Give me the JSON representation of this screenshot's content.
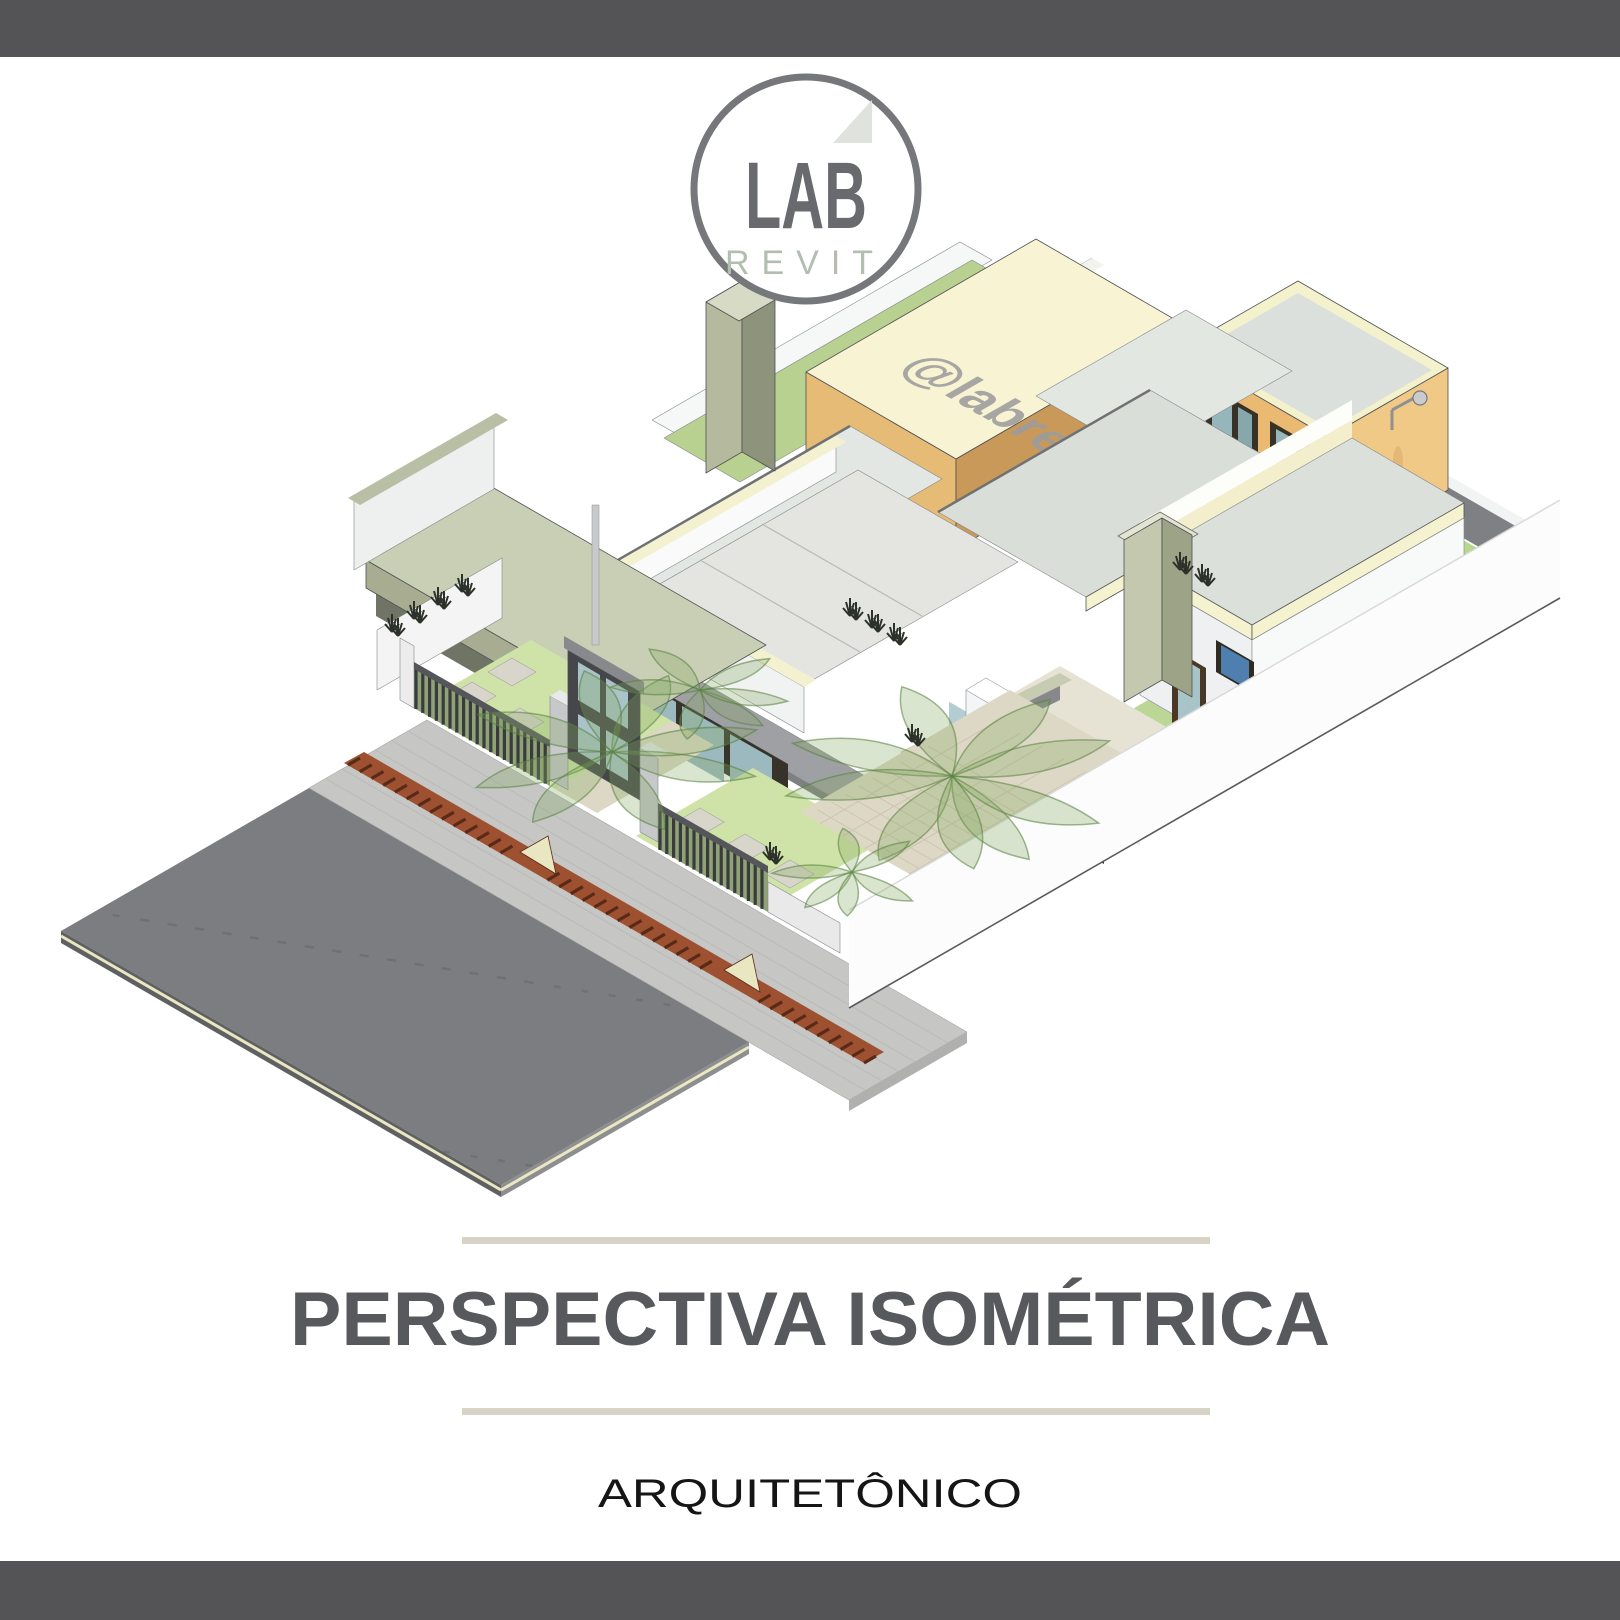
{
  "page": {
    "type": "social-media architectural graphic",
    "background_color": "#ffffff",
    "top_bar_color": "#545456",
    "bottom_bar_color": "#545456"
  },
  "logo": {
    "line1": "LAB",
    "line2": "REVIT",
    "ring_color": "#76777a",
    "lab_color": "#696a6d",
    "revit_color": "#b1beb0",
    "triangle_color": "#dfe2dd"
  },
  "watermark": {
    "text": "@labrevit",
    "color": "#9c9c9c"
  },
  "title_block": {
    "title": "PERSPECTIVA ISOMÉTRICA",
    "title_color": "#58595c",
    "rule_color": "#d8d2c7",
    "subtitle": "ARQUITETÔNICO",
    "subtitle_color": "#151515"
  },
  "scene": {
    "description": "Isometric cutaway Revit model of a duplex house: asphalt street, paver sidewalk with terracotta drainage channel, dark slatted front fence with gate and gabion pillars, front lawns with concrete pavers and translucent plants, sage carport canopy, white cut walls with cream caps, tan clerestory roof volume, light gable and flat roofs, two-storey orange tower with outdoor shower, enclosed back lawn",
    "palette": {
      "asphalt": "#7c7d80",
      "sidewalk": "#c6c6c4",
      "channel_terracotta": "#9e5130",
      "curb_cream": "#eae7c2",
      "front_lawn": "#cfe3a8",
      "back_lawn": "#b7d78d",
      "paver_gray": "#d8d6ca",
      "fence_dark": "#3a3b3e",
      "gate_dark": "#46474a",
      "gabion_gray": "#c6c8ca",
      "canopy_sage": "#c9cfb5",
      "wall_white": "#f1f2f2",
      "wall_cap_cream": "#f4f1cf",
      "tan_wall": "#c9995a",
      "tan_wall_light": "#e6bb75",
      "monitor_roof_cream": "#f7f3d3",
      "roof_gray_green": "#d9ded9",
      "green_roof": "#b9d190",
      "tower_orange": "#eaba72",
      "tower_orange_light": "#f1c987",
      "glass_teal": "#9cb9bf",
      "slab_gray": "#9ea0a3",
      "terrace_beige": "#ddd8c5"
    }
  }
}
